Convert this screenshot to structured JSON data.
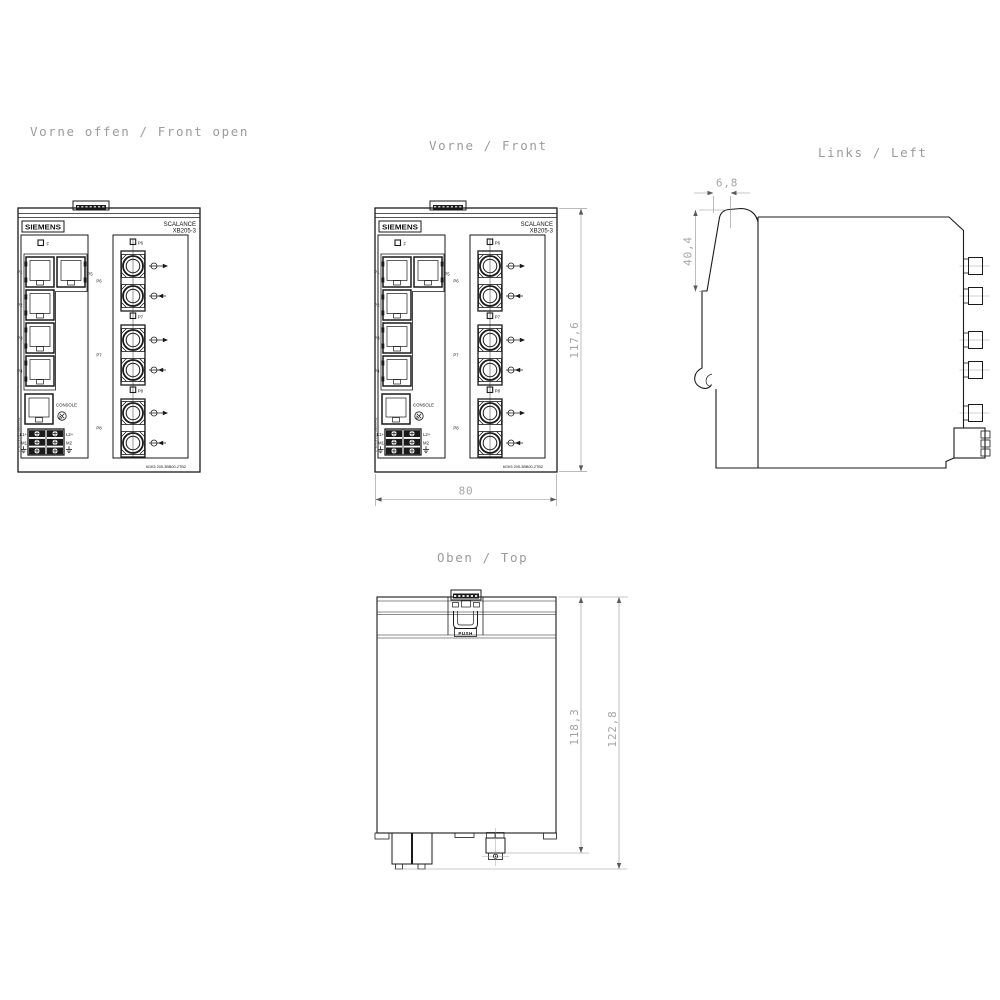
{
  "titles": {
    "front_open": "Vorne offen / Front open",
    "front": "Vorne / Front",
    "left": "Links / Left",
    "top": "Oben / Top"
  },
  "dimensions_mm": {
    "front_height": "117,6",
    "front_width": "80",
    "left_rail_tab_depth": "6,8",
    "left_rail_height": "40,4",
    "top_depth_to_terminal": "118,3",
    "top_depth_overall": "122,8"
  },
  "device": {
    "brand": "SIEMENS",
    "product_line": "SCALANCE",
    "model": "XB205-3",
    "article_number": "6GK5 205-3BB00-2TB2",
    "led_fault": "F",
    "tp_port_labels": [
      "P1",
      "P2",
      "P3",
      "P4"
    ],
    "tp_port5_label": "P5",
    "fo_port_labels": [
      "P6",
      "P7",
      "P8"
    ],
    "console_label": "CONSOLE",
    "power_terminal_left": [
      "L1+",
      "M1"
    ],
    "power_terminal_right": [
      "L2+",
      "M2"
    ],
    "side_print": "F: TP FX FX1 LAN SYS1",
    "push_label": "PUSH"
  }
}
